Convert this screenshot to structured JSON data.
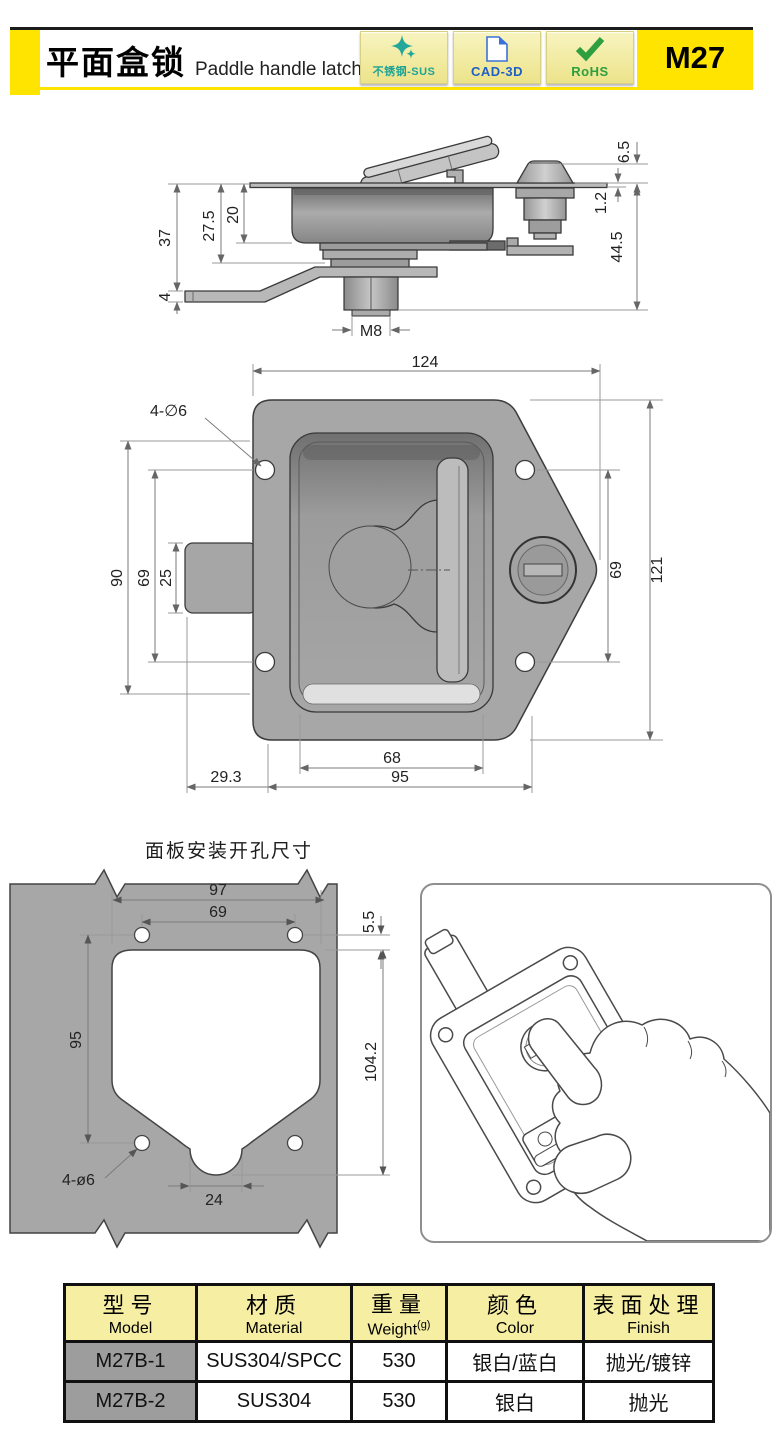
{
  "header": {
    "title_cn": "平面盒锁",
    "title_en": "Paddle handle latch",
    "model_code": "M27",
    "badges": [
      {
        "label": "不锈钢-SUS",
        "icon": "sparkle-icon",
        "color": "#1fa396"
      },
      {
        "label": "CAD-3D",
        "icon": "cad-document-icon",
        "color": "#1f5fc4"
      },
      {
        "label": "RoHS",
        "icon": "checkmark-icon",
        "color": "#2e9e3e"
      }
    ]
  },
  "colors": {
    "accent_yellow": "#ffe400",
    "badge_background": "#f1eca4",
    "table_header_yellow": "#f6eea2",
    "model_cell_gray": "#9d9d9d",
    "drawing_gray": "#a7a7a7"
  },
  "side_view": {
    "labels": {
      "h37": "37",
      "h27_5": "27.5",
      "h20": "20",
      "h4": "4",
      "m8": "M8",
      "d6_5": "6.5",
      "d1_2": "1.2",
      "d44_5": "44.5"
    }
  },
  "front_view": {
    "labels": {
      "w124": "124",
      "holes": "4-∅6",
      "h90": "90",
      "h69l": "69",
      "h25": "25",
      "h69r": "69",
      "h121": "121",
      "w68": "68",
      "w95": "95",
      "w29_3": "29.3"
    }
  },
  "cutout": {
    "title": "面板安装开孔尺寸",
    "labels": {
      "w97": "97",
      "w69": "69",
      "t5_5": "5.5",
      "h95": "95",
      "h104_2": "104.2",
      "w24": "24",
      "holes": "4-ø6"
    }
  },
  "table": {
    "headers": [
      {
        "cn": "型号",
        "en": "Model",
        "sup": ""
      },
      {
        "cn": "材质",
        "en": "Material",
        "sup": ""
      },
      {
        "cn": "重量",
        "en": "Weight",
        "sup": "(g)"
      },
      {
        "cn": "颜色",
        "en": "Color",
        "sup": ""
      },
      {
        "cn": "表面处理",
        "en": "Finish",
        "sup": ""
      }
    ],
    "rows": [
      [
        "M27B-1",
        "SUS304/SPCC",
        "530",
        "银白/蓝白",
        "抛光/镀锌"
      ],
      [
        "M27B-2",
        "SUS304",
        "530",
        "银白",
        "抛光"
      ]
    ]
  }
}
